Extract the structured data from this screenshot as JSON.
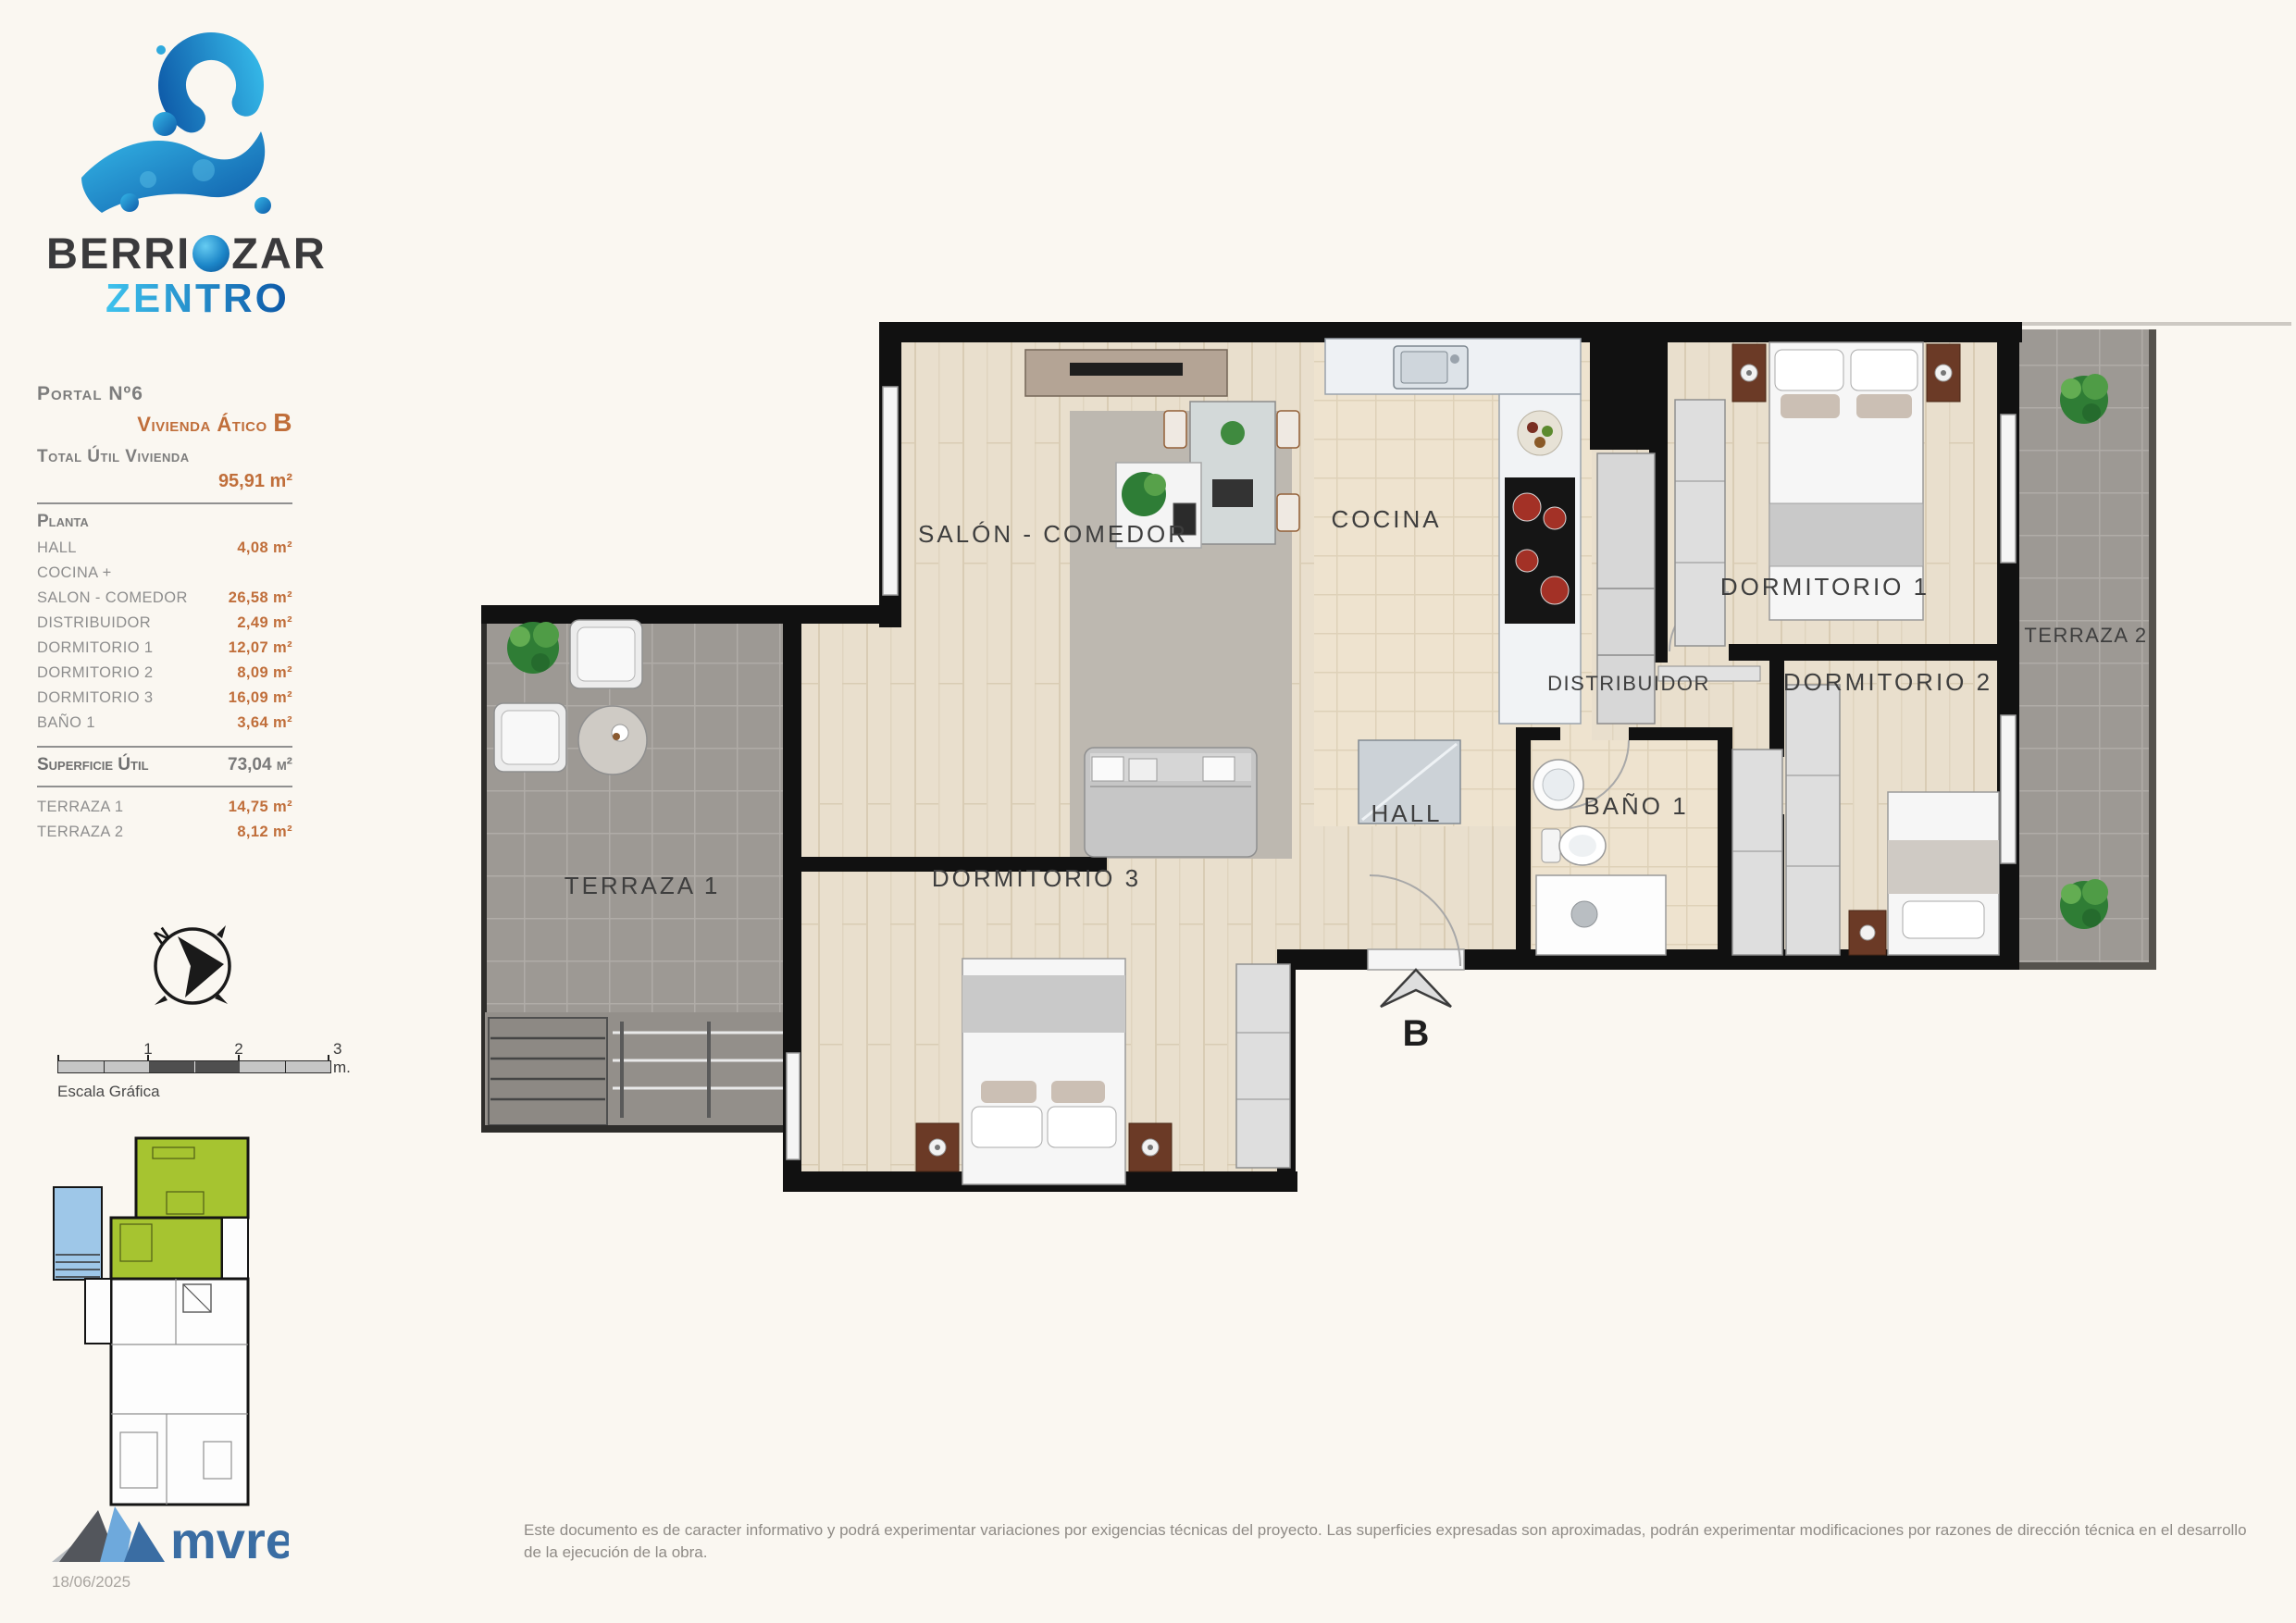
{
  "brand": {
    "name_part1": "BERRI",
    "name_part2": "ZAR",
    "name_line2": "ZENTRO"
  },
  "sidebar": {
    "portal": "Portal Nº6",
    "vivienda_label": "Vivienda",
    "vivienda_type": "Ático",
    "vivienda_letter": "B",
    "total_label": "Total Útil Vivienda",
    "total_value": "95,91 m²",
    "planta_label": "Planta",
    "rooms": [
      {
        "label": "HALL",
        "value": "4,08 m²"
      },
      {
        "label": "COCINA +",
        "value": ""
      },
      {
        "label": "SALON - COMEDOR",
        "value": "26,58 m²"
      },
      {
        "label": "DISTRIBUIDOR",
        "value": "2,49 m²"
      },
      {
        "label": "DORMITORIO 1",
        "value": "12,07 m²"
      },
      {
        "label": "DORMITORIO 2",
        "value": "8,09 m²"
      },
      {
        "label": "DORMITORIO 3",
        "value": "16,09 m²"
      },
      {
        "label": "BAÑO 1",
        "value": "3,64 m²"
      }
    ],
    "superficie_label": "Superficie Útil",
    "superficie_value": "73,04 m²",
    "terraces": [
      {
        "label": "TERRAZA 1",
        "value": "14,75 m²"
      },
      {
        "label": "TERRAZA 2",
        "value": "8,12 m²"
      }
    ]
  },
  "compass": {
    "north_label": "N"
  },
  "scale_bar": {
    "tick1": "1",
    "tick2": "2",
    "end_label": "3 m.",
    "caption": "Escala Gráfica"
  },
  "plan": {
    "rooms": [
      "SALÓN - COMEDOR",
      "COCINA",
      "DORMITORIO 1",
      "TERRAZA 2",
      "DISTRIBUIDOR",
      "DORMITORIO 2",
      "HALL",
      "BAÑO 1",
      "DORMITORIO 3",
      "TERRAZA 1"
    ],
    "entrance_label": "B"
  },
  "footer": {
    "logo_text": "mvre",
    "date": "18/06/2025",
    "disclaimer": "Este documento es de caracter informativo y podrá experimentar variaciones por exigencias técnicas del proyecto. Las superficies expresadas son aproximadas, podrán experimentar modificaciones por razones de dirección técnica en el desarrollo de la ejecución de la obra."
  },
  "colors": {
    "accent_orange": "#c06e3a",
    "brand_blue_light": "#3ec3ee",
    "brand_blue_dark": "#0d57a6",
    "unit_highlight_green": "#a6c430",
    "terrace_blue": "#9ec7e8",
    "terrace_gray": "#9d9994",
    "wall_black": "#111111"
  }
}
